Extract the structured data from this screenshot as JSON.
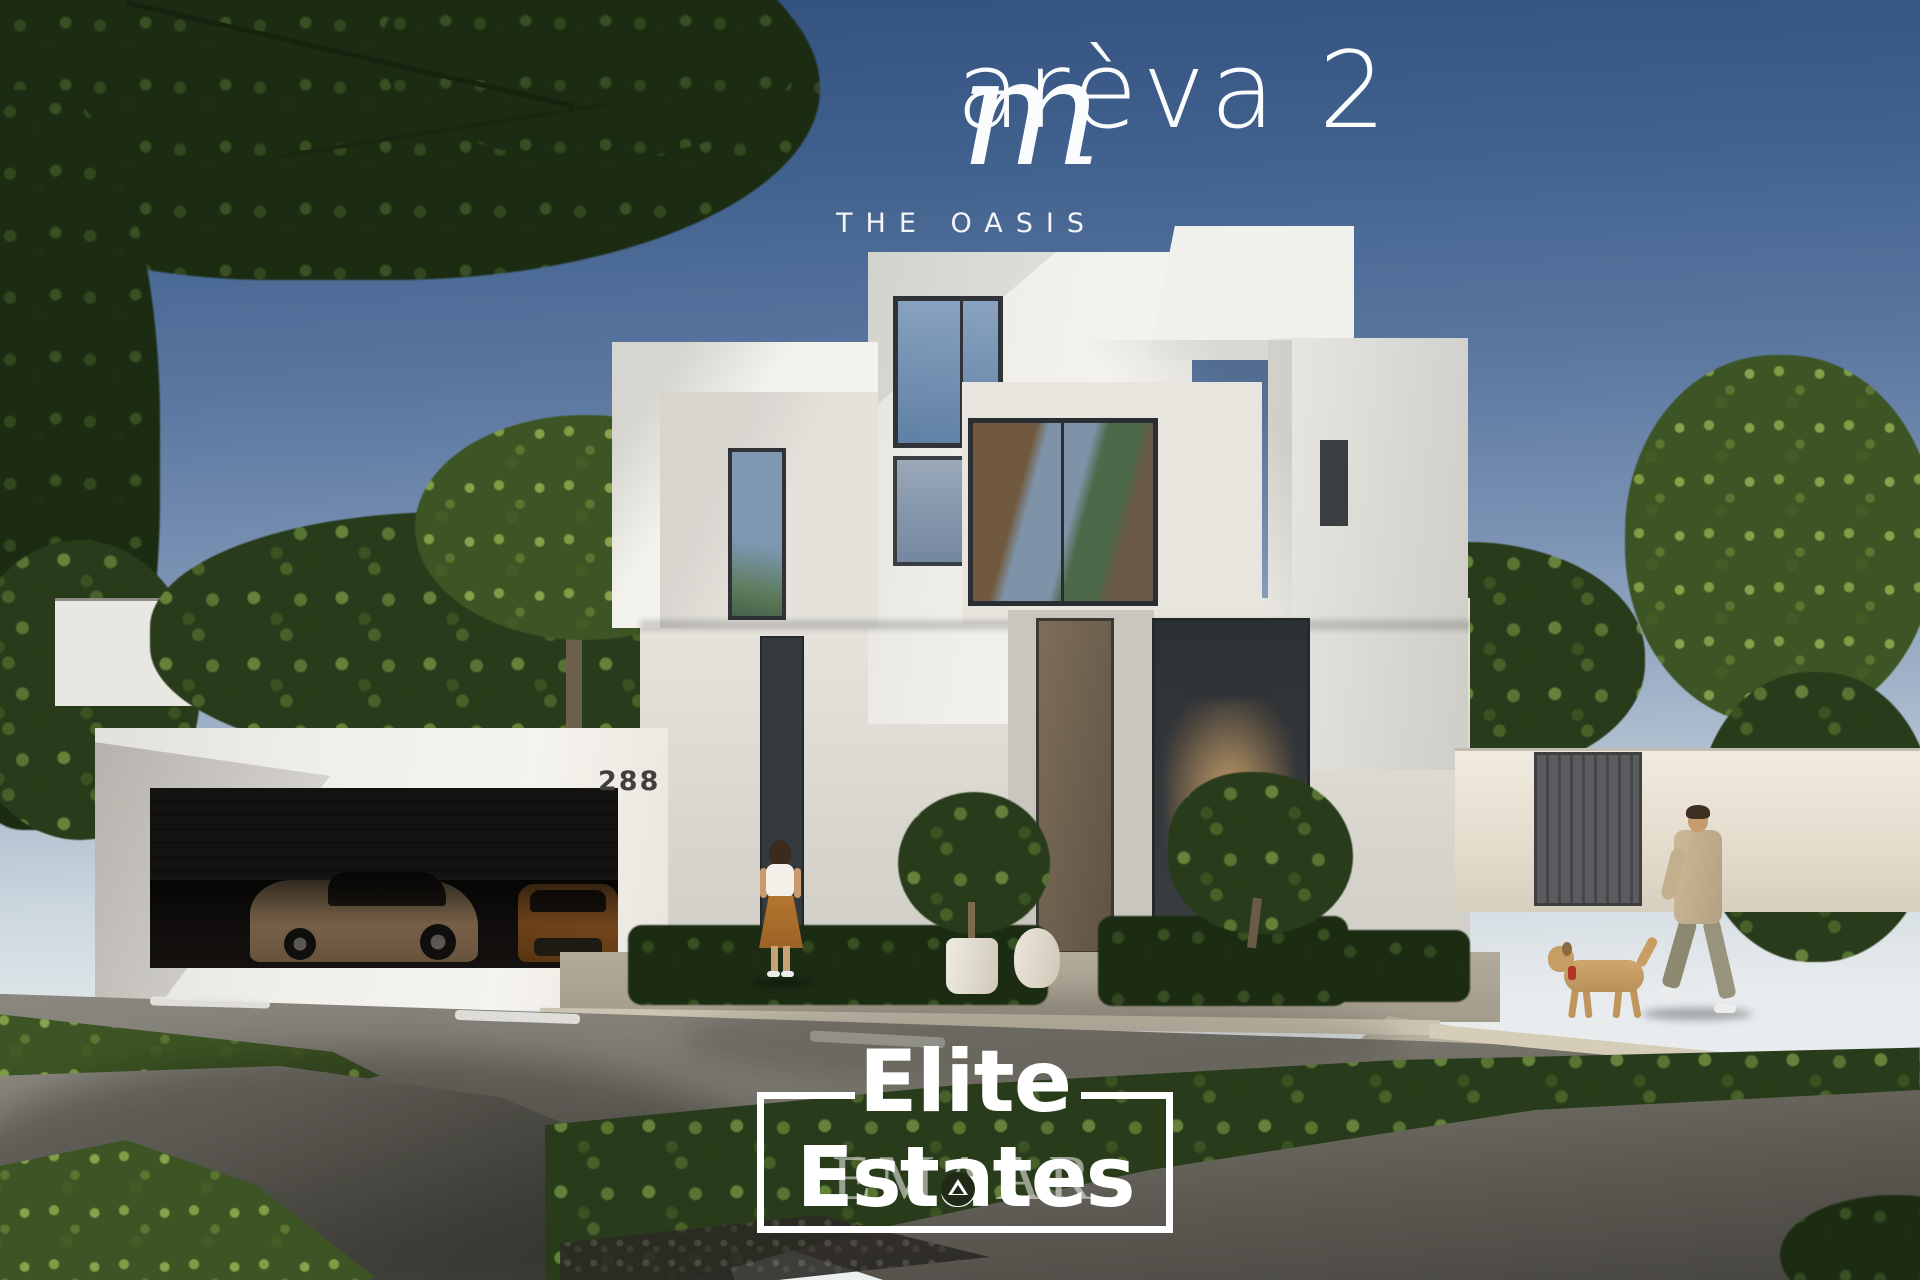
{
  "branding": {
    "script_initial": "m",
    "name_rest": "arèva 2",
    "name_full": "marèva 2",
    "tagline": "THE OASIS"
  },
  "villa": {
    "house_number": "288"
  },
  "watermark": {
    "line1": "Elite",
    "line2": "Estates",
    "developer": "EMAAR"
  },
  "colors": {
    "sky_top": "#32507e",
    "sky_horizon": "#edf0f1",
    "villa_white": "#f2f0ea",
    "foliage_dark": "#1b2c13",
    "foliage_light": "#6d8c49",
    "road": "#6f6d66",
    "path_dark": "#34332f",
    "skirt_ochre": "#b5772f",
    "car_bronze": "#9c8265",
    "car_brown": "#8c5522",
    "text_white": "#ffffff"
  }
}
